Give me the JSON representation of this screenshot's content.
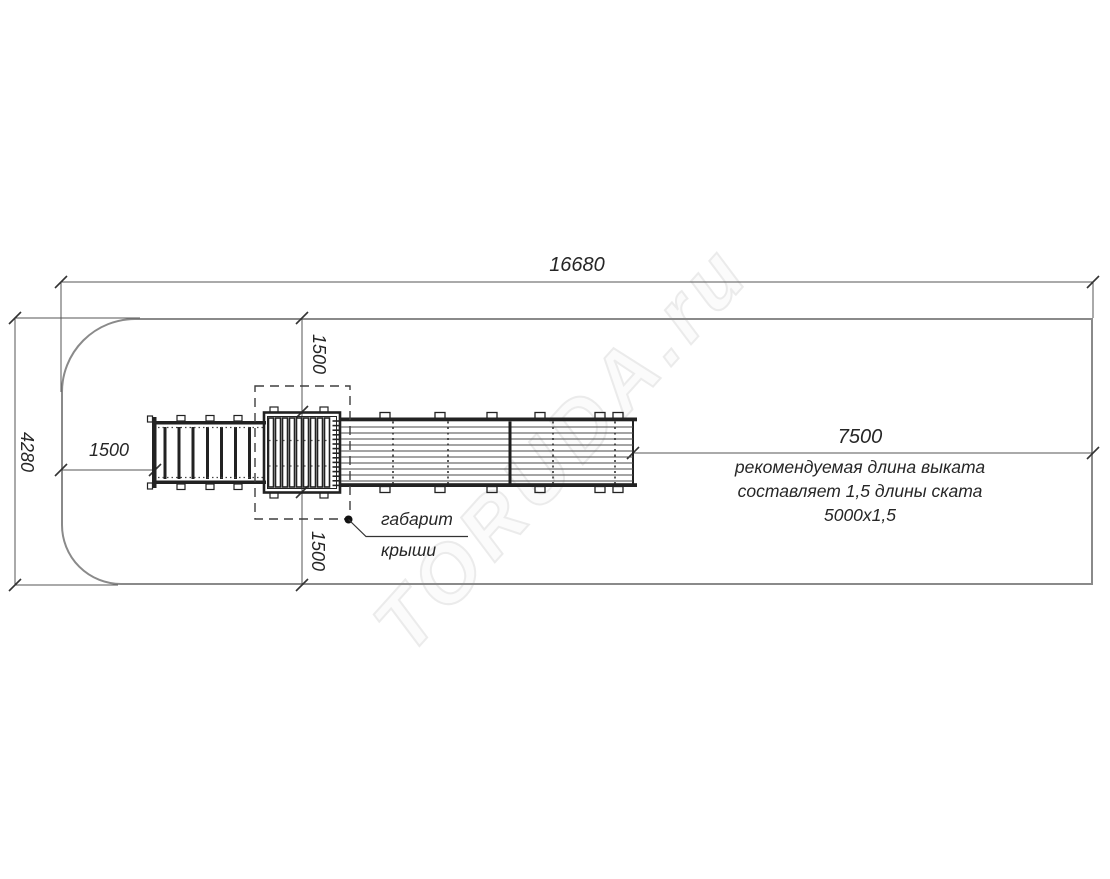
{
  "dimensions": {
    "overall_length": "16680",
    "overall_width": "4280",
    "approach_left": "1500",
    "roof_clearance_top": "1500",
    "roof_clearance_bottom": "1500",
    "runout": "7500"
  },
  "notes": {
    "runout_line1": "рекомендуемая длина выката",
    "runout_line2": "составляет 1,5 длины ската",
    "runout_line3": "5000х1,5",
    "roof_line1": "габарит",
    "roof_line2": "крыши"
  },
  "watermark": {
    "text": "TORUDA.ru"
  },
  "colors": {
    "boundary": "#8a8a8a",
    "dimension": "#555555",
    "structure": "#222222",
    "text": "#262626",
    "watermark_stroke": "#ebebeb"
  }
}
